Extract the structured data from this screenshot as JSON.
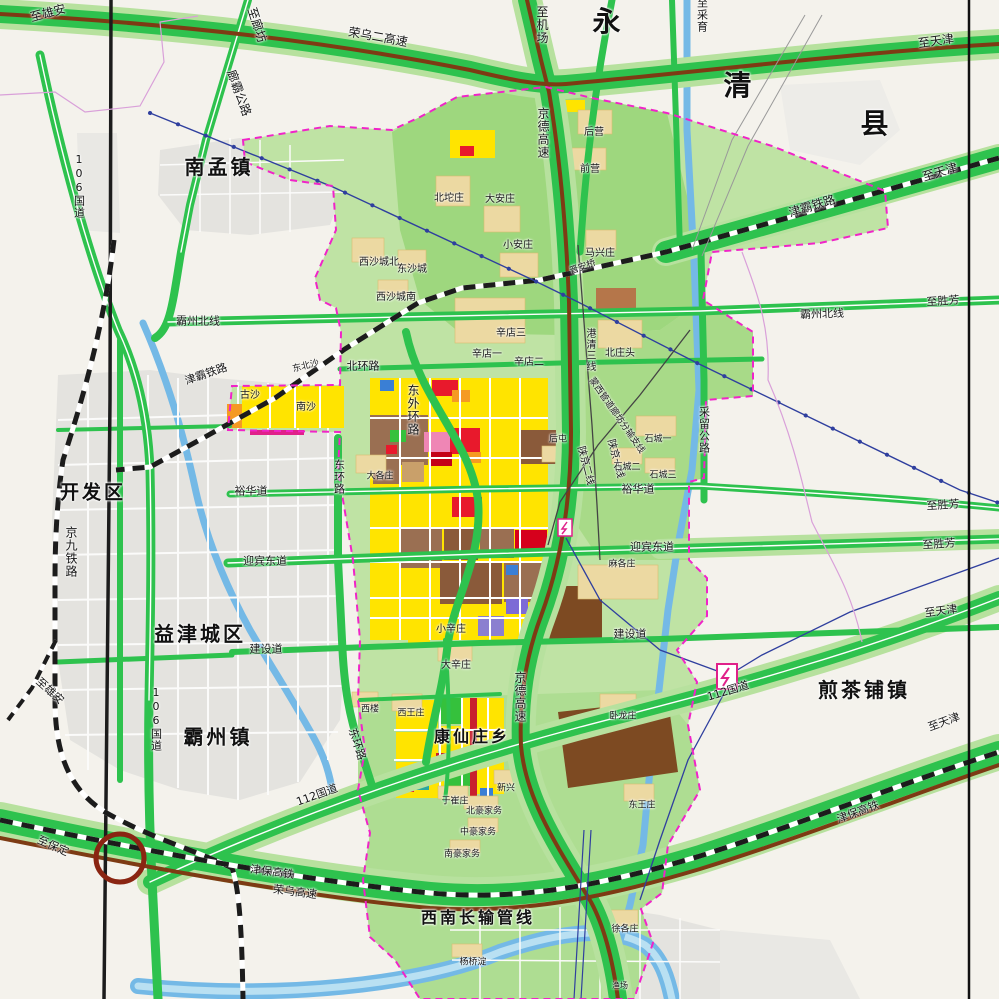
{
  "map": {
    "type": "urban-planning-map",
    "area": "霸州市城乡总体规划示意图",
    "colors": {
      "background": "#f4f2ec",
      "built_up_gray": "#e4e3df",
      "planning_green_light": "#bfe3a4",
      "planning_green_mid": "#9ed77e",
      "road_green": "#2ec24e",
      "road_halo_green": "#b7e19e",
      "expressway_brown": "#7d3b14",
      "railway_black": "#1c1c1c",
      "water_blue": "#74b9e6",
      "boundary_magenta": "#f024c8",
      "pipeline_blue": "#2f3f9e",
      "residential_yellow": "#ffe400",
      "commercial_red": "#e8192c",
      "industrial_brown": "#9a6f52",
      "special_purple": "#7d6bd6",
      "utility_orange": "#f59a23",
      "park_green_block": "#35c13c"
    },
    "symbols": [
      {
        "name": "substation-symbol",
        "x": 727,
        "y": 676
      },
      {
        "name": "substation-symbol-small",
        "x": 565,
        "y": 527
      },
      {
        "name": "interchange-circle",
        "x": 120,
        "y": 858
      }
    ],
    "labels": [
      {
        "t": "至雄安",
        "x": 48,
        "y": 13,
        "r": -15,
        "s": 12,
        "k": "direction"
      },
      {
        "t": "至廊坊",
        "x": 257,
        "y": 25,
        "r": 72,
        "s": 12,
        "k": "direction"
      },
      {
        "t": "廊霸公路",
        "x": 239,
        "y": 93,
        "r": 70,
        "s": 12,
        "k": "road"
      },
      {
        "t": "荣乌二高速",
        "x": 378,
        "y": 37,
        "r": 10,
        "s": 12,
        "k": "expressway"
      },
      {
        "t": "至机场",
        "x": 542,
        "y": 25,
        "v": 1,
        "s": 12,
        "k": "direction"
      },
      {
        "t": "永",
        "x": 608,
        "y": 22,
        "s": 28,
        "b": 1,
        "k": "region"
      },
      {
        "t": "清",
        "x": 739,
        "y": 86,
        "s": 28,
        "b": 1,
        "k": "region"
      },
      {
        "t": "县",
        "x": 876,
        "y": 124,
        "s": 28,
        "b": 1,
        "k": "region"
      },
      {
        "t": "至采育",
        "x": 702,
        "y": 15,
        "v": 1,
        "s": 11,
        "k": "direction"
      },
      {
        "t": "至天津",
        "x": 936,
        "y": 41,
        "r": -8,
        "s": 12,
        "k": "direction"
      },
      {
        "t": "京德高速",
        "x": 543,
        "y": 133,
        "v": 1,
        "s": 12,
        "k": "expressway"
      },
      {
        "t": "津霸铁路",
        "x": 812,
        "y": 206,
        "r": -17,
        "s": 12,
        "k": "railway"
      },
      {
        "t": "至天津",
        "x": 940,
        "y": 172,
        "r": -17,
        "s": 12,
        "k": "direction"
      },
      {
        "t": "南孟镇",
        "x": 219,
        "y": 167,
        "s": 20,
        "b": 1,
        "k": "town"
      },
      {
        "t": "106国道",
        "x": 79,
        "y": 186,
        "v": 1,
        "s": 11,
        "k": "road"
      },
      {
        "t": "后营",
        "x": 594,
        "y": 133,
        "s": 10,
        "k": "village"
      },
      {
        "t": "前营",
        "x": 590,
        "y": 170,
        "s": 10,
        "k": "village"
      },
      {
        "t": "北坨庄",
        "x": 449,
        "y": 199,
        "s": 10,
        "k": "village"
      },
      {
        "t": "大安庄",
        "x": 500,
        "y": 200,
        "s": 10,
        "k": "village"
      },
      {
        "t": "小安庄",
        "x": 518,
        "y": 246,
        "s": 10,
        "k": "village"
      },
      {
        "t": "马兴庄",
        "x": 600,
        "y": 254,
        "s": 10,
        "k": "village"
      },
      {
        "t": "晋安桥",
        "x": 583,
        "y": 268,
        "r": -20,
        "s": 9,
        "k": "village"
      },
      {
        "t": "西沙城北",
        "x": 379,
        "y": 263,
        "s": 10,
        "k": "village"
      },
      {
        "t": "东沙城",
        "x": 412,
        "y": 270,
        "s": 10,
        "k": "village"
      },
      {
        "t": "西沙城南",
        "x": 396,
        "y": 298,
        "s": 10,
        "k": "village"
      },
      {
        "t": "霸州北线",
        "x": 198,
        "y": 321,
        "s": 11,
        "k": "road"
      },
      {
        "t": "霸州北线",
        "x": 822,
        "y": 314,
        "r": -2,
        "s": 11,
        "k": "road"
      },
      {
        "t": "至胜芳",
        "x": 943,
        "y": 301,
        "r": -4,
        "s": 11,
        "k": "direction"
      },
      {
        "t": "津霸铁路",
        "x": 206,
        "y": 374,
        "r": -19,
        "s": 11,
        "k": "railway"
      },
      {
        "t": "东北沙",
        "x": 306,
        "y": 367,
        "r": -14,
        "s": 9,
        "k": "village"
      },
      {
        "t": "北环路",
        "x": 363,
        "y": 366,
        "s": 11,
        "k": "road"
      },
      {
        "t": "古沙",
        "x": 250,
        "y": 396,
        "s": 10,
        "k": "village"
      },
      {
        "t": "南沙",
        "x": 306,
        "y": 408,
        "s": 10,
        "k": "village"
      },
      {
        "t": "东外环路",
        "x": 413,
        "y": 410,
        "v": 1,
        "s": 12,
        "k": "road"
      },
      {
        "t": "辛店三",
        "x": 511,
        "y": 334,
        "s": 10,
        "k": "village"
      },
      {
        "t": "辛店一",
        "x": 487,
        "y": 355,
        "s": 10,
        "k": "village"
      },
      {
        "t": "辛店二",
        "x": 529,
        "y": 363,
        "s": 10,
        "k": "village"
      },
      {
        "t": "北庄头",
        "x": 620,
        "y": 354,
        "s": 10,
        "k": "village"
      },
      {
        "t": "港清三线",
        "x": 589,
        "y": 350,
        "v": 1,
        "s": 10,
        "k": "pipeline"
      },
      {
        "t": "蒙西管道廊坊分输支线",
        "x": 616,
        "y": 416,
        "r": 55,
        "s": 9,
        "k": "pipeline"
      },
      {
        "t": "陕京二线",
        "x": 585,
        "y": 466,
        "r": 75,
        "s": 10,
        "k": "pipeline"
      },
      {
        "t": "陕京一线",
        "x": 615,
        "y": 459,
        "r": 75,
        "s": 10,
        "k": "pipeline"
      },
      {
        "t": "石城一",
        "x": 658,
        "y": 440,
        "s": 9,
        "k": "village"
      },
      {
        "t": "石城二",
        "x": 627,
        "y": 468,
        "s": 9,
        "k": "village"
      },
      {
        "t": "石城三",
        "x": 663,
        "y": 476,
        "s": 9,
        "k": "village"
      },
      {
        "t": "后屯",
        "x": 558,
        "y": 440,
        "s": 9,
        "k": "village"
      },
      {
        "t": "大各庄",
        "x": 380,
        "y": 477,
        "s": 9,
        "k": "village"
      },
      {
        "t": "开发区",
        "x": 93,
        "y": 493,
        "s": 19,
        "b": 1,
        "k": "zone"
      },
      {
        "t": "裕华道",
        "x": 251,
        "y": 491,
        "s": 11,
        "k": "road"
      },
      {
        "t": "裕华道",
        "x": 638,
        "y": 489,
        "s": 11,
        "k": "road"
      },
      {
        "t": "采留公路",
        "x": 704,
        "y": 430,
        "v": 1,
        "s": 11,
        "k": "road"
      },
      {
        "t": "至胜芳",
        "x": 943,
        "y": 505,
        "r": -4,
        "s": 11,
        "k": "direction"
      },
      {
        "t": "至胜芳",
        "x": 939,
        "y": 544,
        "r": -4,
        "s": 11,
        "k": "direction"
      },
      {
        "t": "京九铁路",
        "x": 71,
        "y": 552,
        "v": 1,
        "s": 12,
        "k": "railway"
      },
      {
        "t": "迎宾东道",
        "x": 265,
        "y": 561,
        "s": 11,
        "k": "road"
      },
      {
        "t": "迎宾东道",
        "x": 652,
        "y": 547,
        "s": 11,
        "k": "road"
      },
      {
        "t": "麻各庄",
        "x": 622,
        "y": 565,
        "s": 9,
        "k": "village"
      },
      {
        "t": "至雄安",
        "x": 50,
        "y": 691,
        "r": 42,
        "s": 11,
        "k": "direction"
      },
      {
        "t": "益津城区",
        "x": 200,
        "y": 634,
        "s": 20,
        "b": 1,
        "k": "zone"
      },
      {
        "t": "建设道",
        "x": 266,
        "y": 649,
        "s": 11,
        "k": "road"
      },
      {
        "t": "建设道",
        "x": 630,
        "y": 634,
        "s": 11,
        "k": "road"
      },
      {
        "t": "至天津",
        "x": 941,
        "y": 611,
        "r": -8,
        "s": 11,
        "k": "direction"
      },
      {
        "t": "小辛庄",
        "x": 451,
        "y": 630,
        "s": 10,
        "k": "village"
      },
      {
        "t": "大辛庄",
        "x": 456,
        "y": 666,
        "s": 10,
        "k": "village"
      },
      {
        "t": "东环路",
        "x": 339,
        "y": 477,
        "v": 1,
        "s": 11,
        "k": "road"
      },
      {
        "t": "106国道",
        "x": 156,
        "y": 719,
        "v": 1,
        "s": 11,
        "k": "road"
      },
      {
        "t": "霸州镇",
        "x": 218,
        "y": 737,
        "s": 20,
        "b": 1,
        "k": "town"
      },
      {
        "t": "西楼",
        "x": 370,
        "y": 710,
        "s": 9,
        "k": "village"
      },
      {
        "t": "西王庄",
        "x": 411,
        "y": 714,
        "s": 9,
        "k": "village"
      },
      {
        "t": "康仙庄乡",
        "x": 472,
        "y": 737,
        "s": 16,
        "b": 1,
        "k": "town"
      },
      {
        "t": "京德高速",
        "x": 520,
        "y": 697,
        "v": 1,
        "s": 12,
        "k": "expressway"
      },
      {
        "t": "卧龙庄",
        "x": 623,
        "y": 717,
        "s": 9,
        "k": "village"
      },
      {
        "t": "东环路",
        "x": 357,
        "y": 744,
        "r": 72,
        "s": 11,
        "k": "road"
      },
      {
        "t": "112国道",
        "x": 728,
        "y": 691,
        "r": -17,
        "s": 11,
        "k": "road"
      },
      {
        "t": "煎茶铺镇",
        "x": 864,
        "y": 690,
        "s": 20,
        "b": 1,
        "k": "town"
      },
      {
        "t": "112国道",
        "x": 317,
        "y": 795,
        "r": -20,
        "s": 11,
        "k": "road"
      },
      {
        "t": "至保定",
        "x": 53,
        "y": 846,
        "r": 24,
        "s": 11,
        "k": "direction"
      },
      {
        "t": "津保高铁",
        "x": 272,
        "y": 872,
        "r": 7,
        "s": 11,
        "k": "railway"
      },
      {
        "t": "荣乌高速",
        "x": 295,
        "y": 892,
        "r": 7,
        "s": 11,
        "k": "expressway"
      },
      {
        "t": "津保高铁",
        "x": 858,
        "y": 812,
        "r": -20,
        "s": 11,
        "k": "railway"
      },
      {
        "t": "至天津",
        "x": 944,
        "y": 722,
        "r": -20,
        "s": 11,
        "k": "direction"
      },
      {
        "t": "新兴",
        "x": 506,
        "y": 789,
        "s": 9,
        "k": "village"
      },
      {
        "t": "于崔庄",
        "x": 455,
        "y": 802,
        "s": 9,
        "k": "village"
      },
      {
        "t": "北豪家务",
        "x": 484,
        "y": 812,
        "s": 9,
        "k": "village"
      },
      {
        "t": "中豪家务",
        "x": 478,
        "y": 833,
        "s": 9,
        "k": "village"
      },
      {
        "t": "南豪家务",
        "x": 462,
        "y": 855,
        "s": 9,
        "k": "village"
      },
      {
        "t": "东王庄",
        "x": 642,
        "y": 806,
        "s": 9,
        "k": "village"
      },
      {
        "t": "西南长输管线",
        "x": 478,
        "y": 918,
        "s": 16,
        "b": 1,
        "k": "pipeline"
      },
      {
        "t": "徐各庄",
        "x": 625,
        "y": 930,
        "s": 9,
        "k": "village"
      },
      {
        "t": "杨桥淀",
        "x": 473,
        "y": 963,
        "s": 9,
        "k": "village"
      },
      {
        "t": "渔场",
        "x": 620,
        "y": 986,
        "s": 8,
        "k": "village"
      }
    ]
  }
}
